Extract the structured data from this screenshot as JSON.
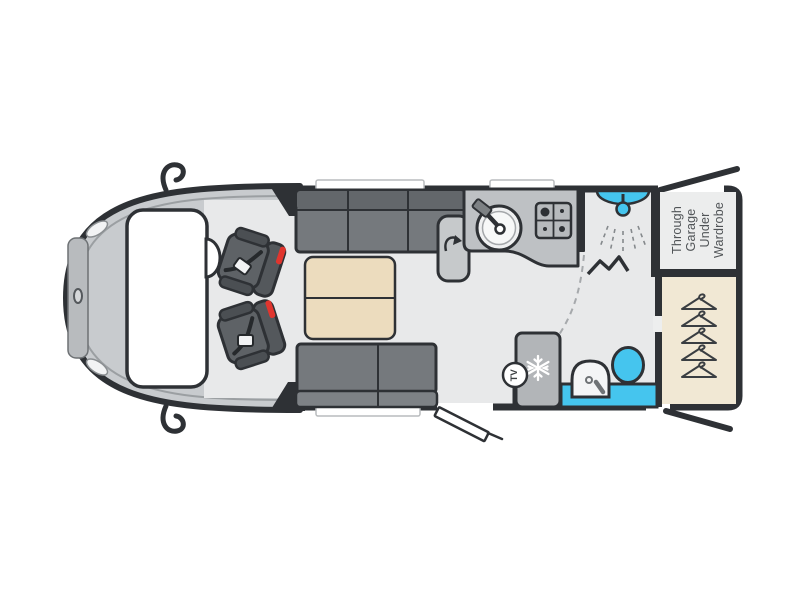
{
  "floorplan": {
    "type": "motorhome-floorplan",
    "labels": {
      "garage_note_line1": "Through",
      "garage_note_line2": "Garage",
      "garage_note_line3": "Under",
      "garage_note_line4": "Wardrobe",
      "tv_label": "TV"
    },
    "colors": {
      "outline": "#2e3135",
      "floor": "#e8e9ea",
      "vehicle_body": "#c8cbce",
      "upholstery": "#75797d",
      "upholstery_dark": "#63676b",
      "cab_seat": "#54585c",
      "seatbelt_red": "#e0352e",
      "worktop": "#bec1c4",
      "fridge": "#b2b5b8",
      "water_blue": "#45c5ee",
      "table_beige": "#ecdcbe",
      "wardrobe_beige": "#f1e8d4",
      "label_text": "#505457"
    },
    "components": [
      "cab with two swivel seats",
      "front lounge with facing sofas and table",
      "kitchen with sink and hob",
      "shower cubicle",
      "washroom with basin and toilet",
      "fridge",
      "tv point",
      "wardrobe",
      "garage note"
    ]
  }
}
